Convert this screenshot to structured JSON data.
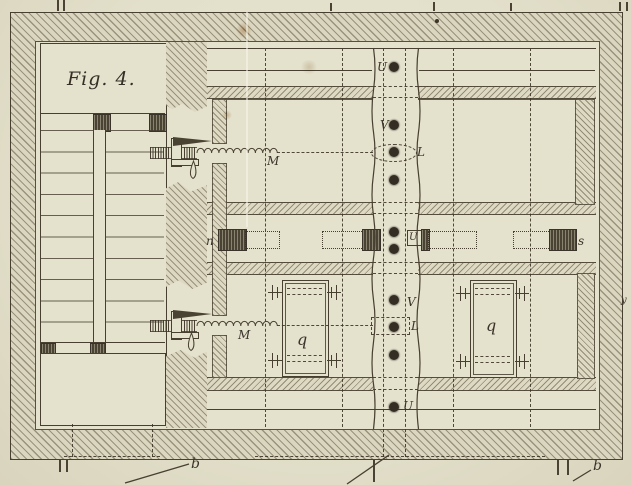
{
  "figure": {
    "title": "Fig. 4."
  },
  "labels": {
    "top_channel_hole": "U",
    "upper_valve": "V",
    "upper_lever": "L",
    "mid_left_slot": "n",
    "mid_channel_box": "U",
    "mid_right_slot": "s",
    "lower_valve": "V",
    "lower_lever": "L",
    "bottom_channel_hole": "U",
    "upper_spring": "M",
    "lower_spring": "M",
    "left_chamber": "q",
    "right_chamber": "q",
    "bottom_left_ref": "b",
    "bottom_right_ref": "b",
    "right_margin_ref": "y"
  },
  "colors": {
    "paper": "#e4e1cd",
    "ink": "#473f30",
    "hatch_tint": "#dbd6bf",
    "stain": "#b98a52"
  }
}
